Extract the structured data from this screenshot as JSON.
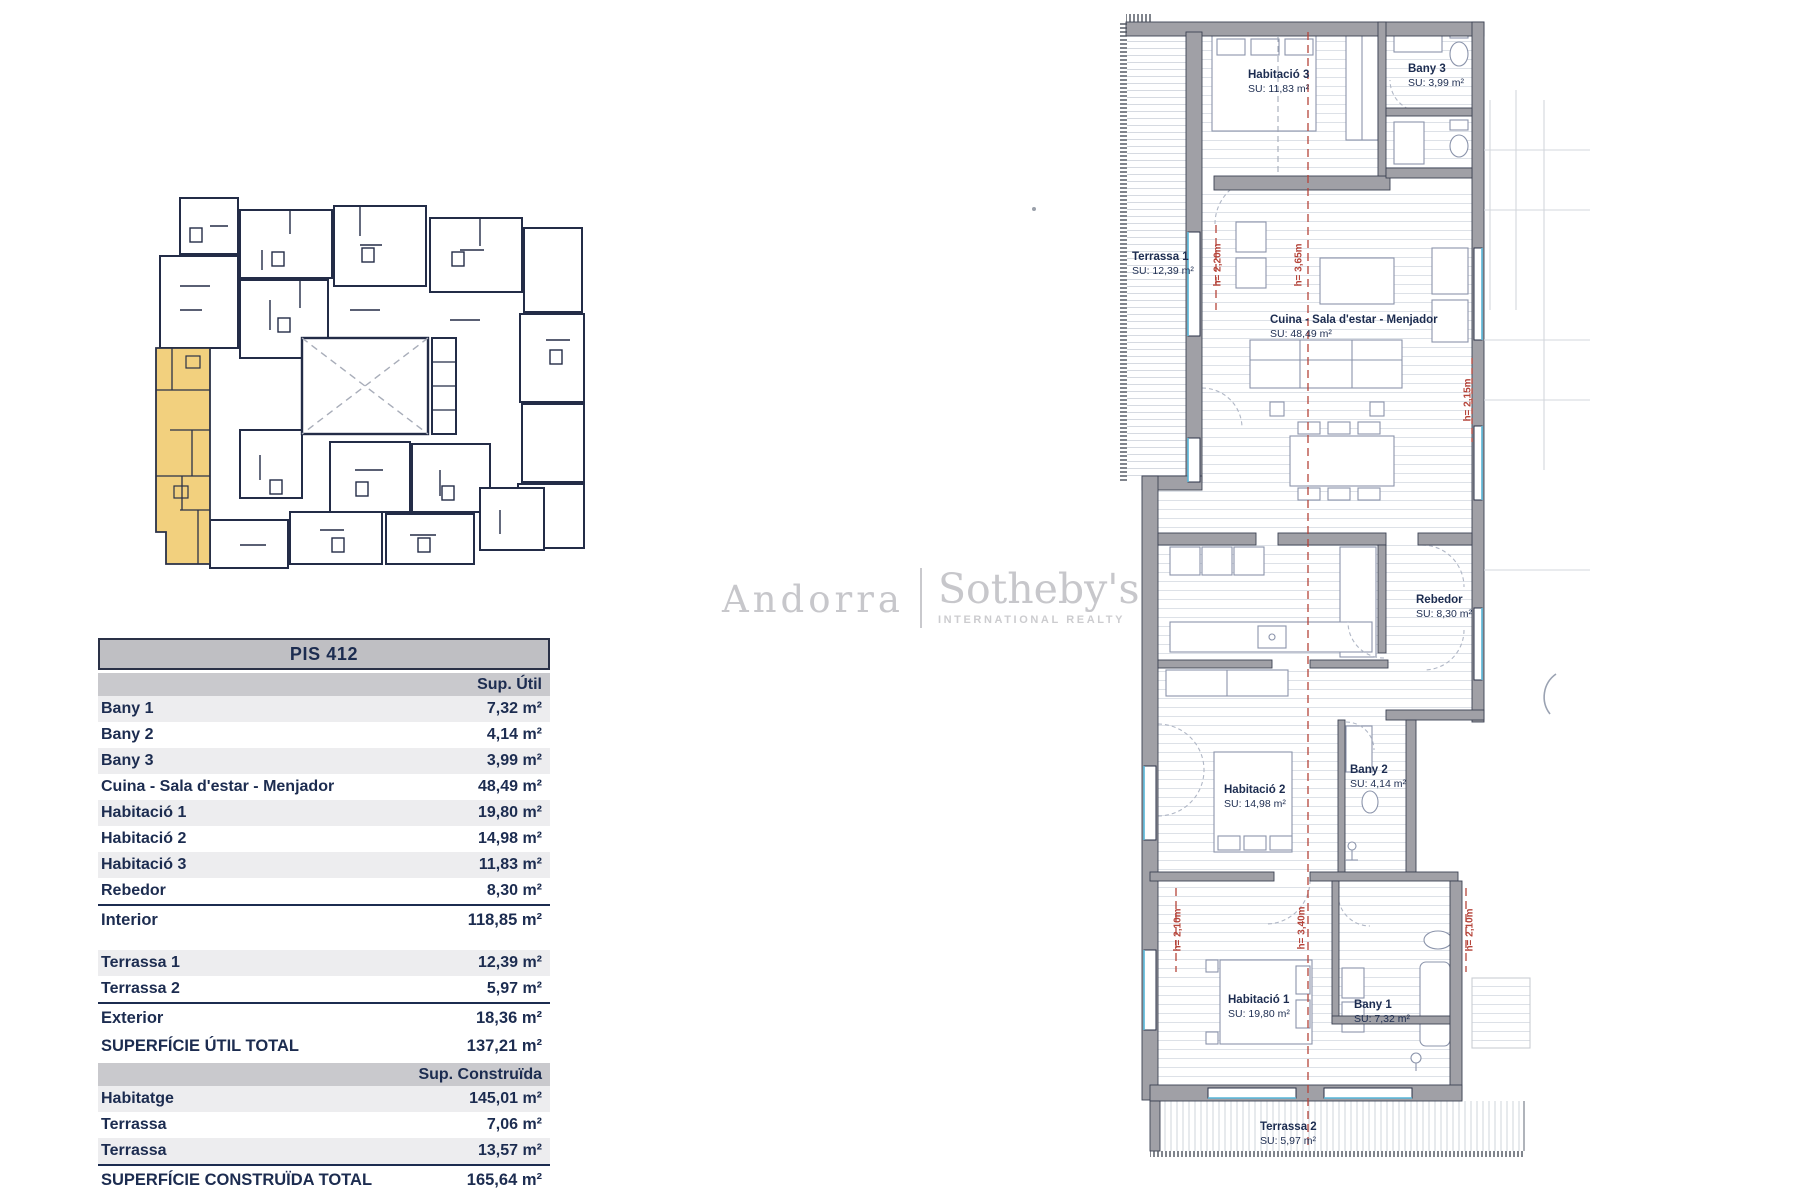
{
  "watermark": {
    "brand_left": "Andorra",
    "brand_right": "Sotheby's",
    "subtitle": "INTERNATIONAL REALTY"
  },
  "table": {
    "title": "PIS 412",
    "col_util": "Sup. Útil",
    "rows_util": [
      {
        "label": "Bany 1",
        "value": "7,32 m²"
      },
      {
        "label": "Bany 2",
        "value": "4,14 m²"
      },
      {
        "label": "Bany 3",
        "value": "3,99 m²"
      },
      {
        "label": "Cuina - Sala d'estar - Menjador",
        "value": "48,49 m²"
      },
      {
        "label": "Habitació 1",
        "value": "19,80 m²"
      },
      {
        "label": "Habitació 2",
        "value": "14,98 m²"
      },
      {
        "label": "Habitació 3",
        "value": "11,83 m²"
      },
      {
        "label": "Rebedor",
        "value": "8,30 m²"
      }
    ],
    "interior": {
      "label": "Interior",
      "value": "118,85 m²"
    },
    "rows_exterior": [
      {
        "label": "Terrassa 1",
        "value": "12,39 m²"
      },
      {
        "label": "Terrassa 2",
        "value": "5,97 m²"
      }
    ],
    "exterior": {
      "label": "Exterior",
      "value": "18,36 m²"
    },
    "util_total": {
      "label": "SUPERFÍCIE ÚTIL TOTAL",
      "value": "137,21 m²"
    },
    "col_construida": "Sup. Construïda",
    "rows_construida": [
      {
        "label": "Habitatge",
        "value": "145,01 m²"
      },
      {
        "label": "Terrassa",
        "value": "7,06 m²"
      },
      {
        "label": "Terrassa",
        "value": "13,57 m²"
      }
    ],
    "construida_total": {
      "label": "SUPERFÍCIE CONSTRUÏDA TOTAL",
      "value": "165,64 m²"
    }
  },
  "floorplan": {
    "rooms": [
      {
        "name": "Habitació 3",
        "su": "SU: 11,83 m²"
      },
      {
        "name": "Bany 3",
        "su": "SU: 3,99 m²"
      },
      {
        "name": "Terrassa 1",
        "su": "SU: 12,39 m²"
      },
      {
        "name": "Cuina - Sala d'estar - Menjador",
        "su": "SU: 48,49 m²"
      },
      {
        "name": "Rebedor",
        "su": "SU: 8,30 m²"
      },
      {
        "name": "Habitació 2",
        "su": "SU: 14,98 m²"
      },
      {
        "name": "Bany 2",
        "su": "SU: 4,14 m²"
      },
      {
        "name": "Habitació 1",
        "su": "SU: 19,80 m²"
      },
      {
        "name": "Bany 1",
        "su": "SU: 7,32 m²"
      },
      {
        "name": "Terrassa 2",
        "su": "SU: 5,97 m²"
      }
    ],
    "heights": [
      {
        "label": "h= 2,20m"
      },
      {
        "label": "h= 3,65m"
      },
      {
        "label": "h= 2,15m"
      },
      {
        "label": "h= 2,10m"
      },
      {
        "label": "h= 3,40m"
      },
      {
        "label": "h= 2,10m"
      }
    ],
    "colors": {
      "wall": "#a0a0a6",
      "line": "#2a3147",
      "highlight": "#f2d07e",
      "annotation": "#b5443a",
      "window_accent": "#57b6d8"
    }
  }
}
